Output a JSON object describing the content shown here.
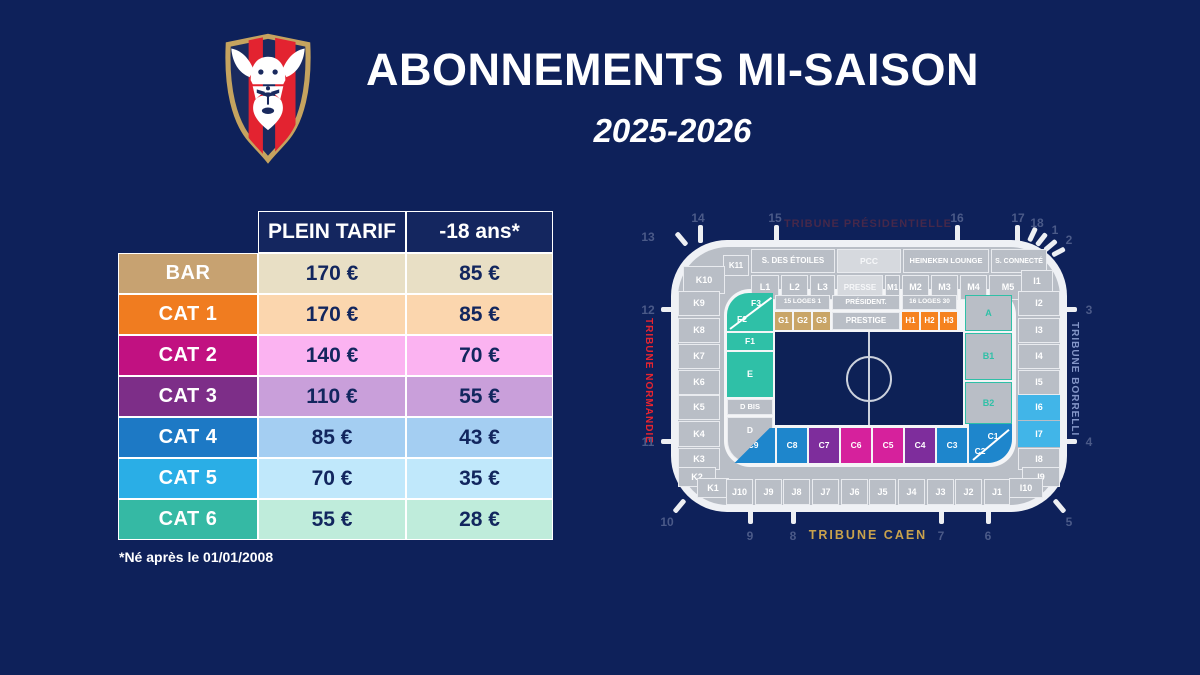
{
  "page": {
    "background": "#0e215a"
  },
  "header": {
    "title": "ABONNEMENTS MI-SAISON",
    "season": "2025-2026",
    "logo": "sm-caen-crest"
  },
  "pricing_table": {
    "columns": [
      "PLEIN TARIF",
      "-18 ans*"
    ],
    "rows": [
      {
        "label": "BAR",
        "full_price": "170 €",
        "youth_price": "85 €",
        "label_color": "#c7a271",
        "cell_color": "#e8dfc5"
      },
      {
        "label": "CAT 1",
        "full_price": "170 €",
        "youth_price": "85 €",
        "label_color": "#f07c20",
        "cell_color": "#fbd6ae"
      },
      {
        "label": "CAT 2",
        "full_price": "140 €",
        "youth_price": "70 €",
        "label_color": "#c11181",
        "cell_color": "#fbb3f1"
      },
      {
        "label": "CAT 3",
        "full_price": "110 €",
        "youth_price": "55 €",
        "label_color": "#7d2e88",
        "cell_color": "#c99fda"
      },
      {
        "label": "CAT 4",
        "full_price": "85 €",
        "youth_price": "43 €",
        "label_color": "#1d79c5",
        "cell_color": "#a4cef2"
      },
      {
        "label": "CAT 5",
        "full_price": "70 €",
        "youth_price": "35 €",
        "label_color": "#2aaee6",
        "cell_color": "#c0e8fb"
      },
      {
        "label": "CAT 6",
        "full_price": "55 €",
        "youth_price": "28 €",
        "label_color": "#35b9a4",
        "cell_color": "#bfecdb"
      }
    ],
    "footnote": "*Né après le 01/01/2008"
  },
  "stadium_map": {
    "tribune_top": "TRIBUNE PRÉSIDENTIELLE",
    "tribune_bottom": "TRIBUNE CAEN",
    "tribune_left": "TRIBUNE NORMANDIE",
    "tribune_right": "TRIBUNE BORRELLI",
    "colors": {
      "gray": "#b9bec6",
      "light_gray": "#d6d9de",
      "teal": "#2fc0a7",
      "tan": "#c9a567",
      "orange": "#f5821f",
      "blue": "#1e86cc",
      "purple": "#7e2d9c",
      "magenta": "#d6219c",
      "cyan": "#41b5e8"
    },
    "gates": [
      {
        "n": "13",
        "x": 25,
        "y": 45
      },
      {
        "n": "14",
        "x": 75,
        "y": 26
      },
      {
        "n": "15",
        "x": 152,
        "y": 26
      },
      {
        "n": "16",
        "x": 334,
        "y": 26
      },
      {
        "n": "17",
        "x": 395,
        "y": 26
      },
      {
        "n": "18",
        "x": 414,
        "y": 31
      },
      {
        "n": "1",
        "x": 432,
        "y": 38
      },
      {
        "n": "2",
        "x": 446,
        "y": 48
      },
      {
        "n": "12",
        "x": 25,
        "y": 118
      },
      {
        "n": "11",
        "x": 25,
        "y": 250
      },
      {
        "n": "3",
        "x": 466,
        "y": 118
      },
      {
        "n": "4",
        "x": 466,
        "y": 250
      },
      {
        "n": "10",
        "x": 44,
        "y": 330
      },
      {
        "n": "9",
        "x": 127,
        "y": 344
      },
      {
        "n": "8",
        "x": 170,
        "y": 344
      },
      {
        "n": "7",
        "x": 318,
        "y": 344
      },
      {
        "n": "6",
        "x": 365,
        "y": 344
      },
      {
        "n": "5",
        "x": 446,
        "y": 330
      }
    ],
    "sections": [
      {
        "label": "S. DES ÉTOILES",
        "x": 128,
        "y": 57,
        "w": 84,
        "h": 24,
        "cls": "g",
        "fs": 8
      },
      {
        "label": "PCC",
        "x": 214,
        "y": 57,
        "w": 64,
        "h": 24,
        "cls": "gl",
        "fs": 8.5
      },
      {
        "label": "HEINEKEN LOUNGE",
        "x": 280,
        "y": 57,
        "w": 86,
        "h": 24,
        "cls": "g",
        "fs": 7.5
      },
      {
        "label": "S. CONNECTÉ",
        "x": 368,
        "y": 57,
        "w": 56,
        "h": 24,
        "cls": "g",
        "fs": 7
      },
      {
        "label": "K11",
        "x": 100,
        "y": 63,
        "w": 26,
        "h": 21,
        "cls": "g",
        "fs": 8
      },
      {
        "label": "K10",
        "x": 60,
        "y": 74,
        "w": 42,
        "h": 28,
        "cls": "g",
        "fs": 9
      },
      {
        "label": "L1",
        "x": 128,
        "y": 83,
        "w": 28,
        "h": 25,
        "cls": "g",
        "fs": 9
      },
      {
        "label": "L2",
        "x": 158,
        "y": 83,
        "w": 27,
        "h": 25,
        "cls": "g",
        "fs": 9
      },
      {
        "label": "L3",
        "x": 187,
        "y": 83,
        "w": 25,
        "h": 25,
        "cls": "g",
        "fs": 9
      },
      {
        "label": "PRESSE",
        "x": 214,
        "y": 83,
        "w": 46,
        "h": 25,
        "cls": "gl",
        "fs": 8
      },
      {
        "label": "M1",
        "x": 262,
        "y": 83,
        "w": 15,
        "h": 25,
        "cls": "g",
        "fs": 8
      },
      {
        "label": "M2",
        "x": 279,
        "y": 83,
        "w": 27,
        "h": 25,
        "cls": "g",
        "fs": 9
      },
      {
        "label": "M3",
        "x": 308,
        "y": 83,
        "w": 27,
        "h": 25,
        "cls": "g",
        "fs": 9
      },
      {
        "label": "M4",
        "x": 337,
        "y": 83,
        "w": 27,
        "h": 25,
        "cls": "g",
        "fs": 9
      },
      {
        "label": "M5",
        "x": 366,
        "y": 83,
        "w": 38,
        "h": 25,
        "cls": "g",
        "fs": 9
      },
      {
        "label": "I1",
        "x": 398,
        "y": 78,
        "w": 32,
        "h": 22,
        "cls": "g",
        "fs": 9
      },
      {
        "label": "K9",
        "x": 55,
        "y": 99,
        "w": 42,
        "h": 25,
        "cls": "g",
        "fs": 9
      },
      {
        "label": "K8",
        "x": 55,
        "y": 126,
        "w": 42,
        "h": 25,
        "cls": "g",
        "fs": 9
      },
      {
        "label": "K7",
        "x": 55,
        "y": 152,
        "w": 42,
        "h": 25,
        "cls": "g",
        "fs": 9
      },
      {
        "label": "K6",
        "x": 55,
        "y": 178,
        "w": 42,
        "h": 25,
        "cls": "g",
        "fs": 9
      },
      {
        "label": "K5",
        "x": 55,
        "y": 203,
        "w": 42,
        "h": 25,
        "cls": "g",
        "fs": 9
      },
      {
        "label": "K4",
        "x": 55,
        "y": 229,
        "w": 42,
        "h": 26,
        "cls": "g",
        "fs": 9
      },
      {
        "label": "K3",
        "x": 55,
        "y": 256,
        "w": 42,
        "h": 22,
        "cls": "g",
        "fs": 9
      },
      {
        "label": "K2",
        "x": 55,
        "y": 275,
        "w": 38,
        "h": 20,
        "cls": "g",
        "fs": 9
      },
      {
        "label": "K1",
        "x": 74,
        "y": 286,
        "w": 32,
        "h": 20,
        "cls": "g",
        "fs": 9
      },
      {
        "label": "I2",
        "x": 395,
        "y": 99,
        "w": 42,
        "h": 25,
        "cls": "g",
        "fs": 9
      },
      {
        "label": "I3",
        "x": 395,
        "y": 126,
        "w": 42,
        "h": 25,
        "cls": "g",
        "fs": 9
      },
      {
        "label": "I4",
        "x": 395,
        "y": 152,
        "w": 42,
        "h": 25,
        "cls": "g",
        "fs": 9
      },
      {
        "label": "I5",
        "x": 395,
        "y": 178,
        "w": 42,
        "h": 25,
        "cls": "g",
        "fs": 9
      },
      {
        "label": "I6",
        "x": 395,
        "y": 203,
        "w": 42,
        "h": 25,
        "cls": "cyn",
        "fs": 9
      },
      {
        "label": "I7",
        "x": 395,
        "y": 229,
        "w": 42,
        "h": 26,
        "cls": "cyn",
        "fs": 9
      },
      {
        "label": "I8",
        "x": 395,
        "y": 256,
        "w": 42,
        "h": 22,
        "cls": "g",
        "fs": 9
      },
      {
        "label": "I9",
        "x": 399,
        "y": 275,
        "w": 38,
        "h": 20,
        "cls": "g",
        "fs": 9
      },
      {
        "label": "I10",
        "x": 386,
        "y": 286,
        "w": 34,
        "h": 20,
        "cls": "g",
        "fs": 9
      },
      {
        "label": "J10",
        "x": 103,
        "y": 287,
        "w": 27,
        "h": 26,
        "cls": "g",
        "fs": 9
      },
      {
        "label": "J9",
        "x": 132,
        "y": 287,
        "w": 27,
        "h": 26,
        "cls": "g",
        "fs": 9
      },
      {
        "label": "J8",
        "x": 160,
        "y": 287,
        "w": 27,
        "h": 26,
        "cls": "g",
        "fs": 9
      },
      {
        "label": "J7",
        "x": 189,
        "y": 287,
        "w": 27,
        "h": 26,
        "cls": "g",
        "fs": 9
      },
      {
        "label": "J6",
        "x": 218,
        "y": 287,
        "w": 27,
        "h": 26,
        "cls": "g",
        "fs": 9
      },
      {
        "label": "J5",
        "x": 246,
        "y": 287,
        "w": 27,
        "h": 26,
        "cls": "g",
        "fs": 9
      },
      {
        "label": "J4",
        "x": 275,
        "y": 287,
        "w": 27,
        "h": 26,
        "cls": "g",
        "fs": 9
      },
      {
        "label": "J3",
        "x": 304,
        "y": 287,
        "w": 27,
        "h": 26,
        "cls": "g",
        "fs": 9
      },
      {
        "label": "J2",
        "x": 332,
        "y": 287,
        "w": 27,
        "h": 26,
        "cls": "g",
        "fs": 9
      },
      {
        "label": "J1",
        "x": 361,
        "y": 287,
        "w": 26,
        "h": 26,
        "cls": "g",
        "fs": 9
      },
      {
        "label": "15 LOGES 1",
        "x": 152,
        "y": 103,
        "w": 55,
        "h": 15,
        "cls": "g",
        "fs": 6.5
      },
      {
        "label": "PRÉSIDENT.",
        "x": 209,
        "y": 103,
        "w": 68,
        "h": 15,
        "cls": "g",
        "fs": 7
      },
      {
        "label": "16 LOGES 30",
        "x": 279,
        "y": 103,
        "w": 55,
        "h": 15,
        "cls": "g",
        "fs": 6.5
      },
      {
        "label": "G1",
        "x": 152,
        "y": 120,
        "w": 17,
        "h": 18,
        "cls": "tan",
        "fs": 8
      },
      {
        "label": "G2",
        "x": 171,
        "y": 120,
        "w": 17,
        "h": 18,
        "cls": "tan",
        "fs": 8
      },
      {
        "label": "G3",
        "x": 190,
        "y": 120,
        "w": 17,
        "h": 18,
        "cls": "tan",
        "fs": 8
      },
      {
        "label": "PRESTIGE",
        "x": 209,
        "y": 120,
        "w": 68,
        "h": 18,
        "cls": "g",
        "fs": 8
      },
      {
        "label": "H1",
        "x": 279,
        "y": 120,
        "w": 17,
        "h": 18,
        "cls": "org",
        "fs": 8
      },
      {
        "label": "H2",
        "x": 298,
        "y": 120,
        "w": 17,
        "h": 18,
        "cls": "org",
        "fs": 8
      },
      {
        "label": "H3",
        "x": 317,
        "y": 120,
        "w": 17,
        "h": 18,
        "cls": "org",
        "fs": 8
      },
      {
        "label": "A",
        "x": 342,
        "y": 103,
        "w": 47,
        "h": 36,
        "cls": "ab",
        "fs": 9
      },
      {
        "label": "B1",
        "x": 342,
        "y": 141,
        "w": 47,
        "h": 47,
        "cls": "ab",
        "fs": 9
      },
      {
        "label": "B2",
        "x": 342,
        "y": 190,
        "w": 47,
        "h": 42,
        "cls": "ab",
        "fs": 9
      },
      {
        "label": "",
        "name": "f-corner",
        "x": 104,
        "y": 101,
        "w": 46,
        "h": 38,
        "cls": "teal",
        "r": "22px 0 0 0"
      },
      {
        "label": "",
        "name": "f-divider",
        "x": 107,
        "y": 136,
        "w": 52,
        "h": 2,
        "cls": "diag",
        "rot": -37
      },
      {
        "label": "F3",
        "x": 120,
        "y": 105,
        "w": 26,
        "h": 13,
        "cls": "txt",
        "fs": 8.5
      },
      {
        "label": "F2",
        "x": 106,
        "y": 121,
        "w": 26,
        "h": 13,
        "cls": "txt",
        "fs": 8.5
      },
      {
        "label": "F1",
        "x": 104,
        "y": 141,
        "w": 46,
        "h": 17,
        "cls": "teal",
        "fs": 8.5
      },
      {
        "label": "E",
        "x": 104,
        "y": 160,
        "w": 46,
        "h": 45,
        "cls": "teal",
        "fs": 9
      },
      {
        "label": "D BIS",
        "x": 104,
        "y": 207,
        "w": 46,
        "h": 16,
        "cls": "g",
        "fs": 7.5
      },
      {
        "label": "D",
        "x": 104,
        "y": 225,
        "w": 46,
        "h": 46,
        "cls": "g top",
        "fs": 8.5,
        "r": "0 0 0 22px"
      },
      {
        "label": "C9",
        "x": 108,
        "y": 236,
        "w": 44,
        "h": 35,
        "cls": "blu",
        "fs": 8.5,
        "clip": "polygon(88% 0, 100% 0, 100% 100%, 8% 100%)"
      },
      {
        "label": "C8",
        "x": 154,
        "y": 236,
        "w": 30,
        "h": 35,
        "cls": "blu",
        "fs": 8.5
      },
      {
        "label": "C7",
        "x": 186,
        "y": 236,
        "w": 30,
        "h": 35,
        "cls": "pur",
        "fs": 8.5
      },
      {
        "label": "C6",
        "x": 218,
        "y": 236,
        "w": 30,
        "h": 35,
        "cls": "mag",
        "fs": 8.5
      },
      {
        "label": "C5",
        "x": 250,
        "y": 236,
        "w": 30,
        "h": 35,
        "cls": "mag",
        "fs": 8.5
      },
      {
        "label": "C4",
        "x": 282,
        "y": 236,
        "w": 30,
        "h": 35,
        "cls": "pur",
        "fs": 8.5
      },
      {
        "label": "C3",
        "x": 314,
        "y": 236,
        "w": 30,
        "h": 35,
        "cls": "blu",
        "fs": 8.5
      },
      {
        "label": "",
        "name": "c-corner",
        "x": 346,
        "y": 232,
        "w": 43,
        "h": 39,
        "cls": "blu",
        "r": "0 0 24px 0"
      },
      {
        "label": "",
        "name": "c-divider",
        "x": 350,
        "y": 267,
        "w": 47,
        "h": 2,
        "cls": "diag",
        "rot": -40
      },
      {
        "label": "C1",
        "x": 358,
        "y": 238,
        "w": 24,
        "h": 12,
        "cls": "txt",
        "fs": 8.5
      },
      {
        "label": "C2",
        "x": 345,
        "y": 253,
        "w": 24,
        "h": 12,
        "cls": "txt",
        "fs": 8.5
      }
    ]
  }
}
